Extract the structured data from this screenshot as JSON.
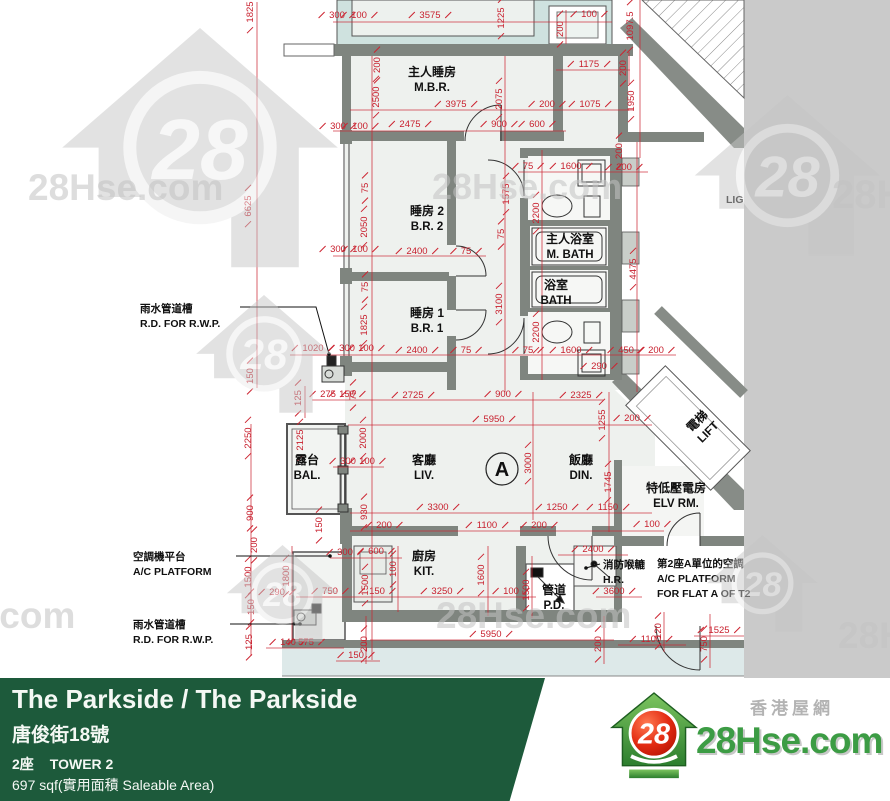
{
  "footer": {
    "title": "The Parkside / The Parkside",
    "address": "唐俊街18號",
    "tower_cn": "2座",
    "tower_en": "TOWER 2",
    "area": "697 sqf(實用面積 Saleable Area)"
  },
  "brand": {
    "site_cn": "香港屋網",
    "site_en": "28Hse.com",
    "logo_number": "28"
  },
  "watermarks": {
    "logo_number": "28",
    "houses": [
      {
        "x": 70,
        "y": 28,
        "s": 2.6
      },
      {
        "x": 700,
        "y": 95,
        "s": 1.75
      },
      {
        "x": 200,
        "y": 295,
        "s": 1.28
      },
      {
        "x": 230,
        "y": 545,
        "s": 1.05
      },
      {
        "x": 710,
        "y": 535,
        "s": 1.05
      }
    ],
    "texts": [
      {
        "t": "28Hse.com",
        "x": 28,
        "y": 200,
        "size": 37
      },
      {
        "t": "28Hse.com",
        "x": 432,
        "y": 199,
        "size": 36
      },
      {
        "t": "28Hse.com",
        "x": 832,
        "y": 208,
        "size": 40
      },
      {
        "t": "28Hse.com",
        "x": 436,
        "y": 628,
        "size": 37
      },
      {
        "t": "28Hse.com",
        "x": -120,
        "y": 628,
        "size": 37
      },
      {
        "t": "28Hse.com",
        "x": 838,
        "y": 648,
        "size": 37
      }
    ]
  },
  "plan": {
    "flat_label": "A",
    "rooms": [
      {
        "cn": "主人睡房",
        "en": "M.B.R.",
        "x": 432,
        "y": 76
      },
      {
        "cn": "睡房 2",
        "en": "B.R. 2",
        "x": 427,
        "y": 215
      },
      {
        "cn": "睡房 1",
        "en": "B.R. 1",
        "x": 427,
        "y": 317
      },
      {
        "cn": "主人浴室",
        "en": "M. BATH",
        "x": 570,
        "y": 243
      },
      {
        "cn": "浴室",
        "en": "BATH",
        "x": 556,
        "y": 289
      },
      {
        "cn": "露台",
        "en": "BAL.",
        "x": 307,
        "y": 464
      },
      {
        "cn": "客廳",
        "en": "LIV.",
        "x": 424,
        "y": 464
      },
      {
        "cn": "飯廳",
        "en": "DIN.",
        "x": 581,
        "y": 464
      },
      {
        "cn": "廚房",
        "en": "KIT.",
        "x": 424,
        "y": 560
      },
      {
        "cn": "管道",
        "en": "P.D.",
        "x": 554,
        "y": 594
      },
      {
        "cn": "電梯",
        "en": "LIFT",
        "x": 700,
        "y": 424,
        "rot": -45
      },
      {
        "cn": "特低壓電房",
        "en": "ELV RM.",
        "x": 676,
        "y": 492
      }
    ],
    "annotations": [
      {
        "lines": [
          "雨水管道槽",
          "R.D. FOR R.W.P."
        ],
        "x": 140,
        "y": 312,
        "leader": [
          [
            240,
            307
          ],
          [
            316,
            307
          ],
          [
            329,
            354
          ]
        ]
      },
      {
        "lines": [
          "空調機平台",
          "A/C PLATFORM"
        ],
        "x": 133,
        "y": 560,
        "leader": [
          [
            236,
            556
          ],
          [
            330,
            556
          ]
        ]
      },
      {
        "lines": [
          "雨水管道槽",
          "R.D. FOR R.W.P."
        ],
        "x": 133,
        "y": 628,
        "leader": [
          [
            230,
            624
          ],
          [
            300,
            624
          ]
        ]
      },
      {
        "lines": [
          "消防喉轆",
          "H.R."
        ],
        "x": 603,
        "y": 568,
        "leader": [
          [
            600,
            564
          ],
          [
            586,
            568
          ]
        ]
      },
      {
        "lines": [
          "第2座A單位的空調",
          "A/C PLATFORM",
          "FOR FLAT A OF T2"
        ],
        "x": 657,
        "y": 567
      },
      {
        "lines": [
          "LIG"
        ],
        "x": 726,
        "y": 203
      }
    ],
    "dimensions": [
      [
        "1825",
        253,
        12,
        1
      ],
      [
        "300",
        337,
        18,
        0
      ],
      [
        "100",
        359,
        18,
        0
      ],
      [
        "3575",
        430,
        18,
        0
      ],
      [
        "100",
        589,
        17,
        0
      ],
      [
        "1225",
        504,
        18,
        1
      ],
      [
        "200",
        563,
        29,
        1
      ],
      [
        "1097.5",
        633,
        26,
        1
      ],
      [
        "1175",
        589,
        67,
        0
      ],
      [
        "200",
        626,
        68,
        1
      ],
      [
        "1950",
        634,
        101,
        1
      ],
      [
        "200",
        622,
        151,
        1
      ],
      [
        "200",
        380,
        65,
        1
      ],
      [
        "2500",
        379,
        97,
        1
      ],
      [
        "3975",
        456,
        107,
        0
      ],
      [
        "2075",
        502,
        99,
        1
      ],
      [
        "200",
        547,
        107,
        0
      ],
      [
        "1075",
        590,
        107,
        0
      ],
      [
        "300",
        338,
        129,
        0
      ],
      [
        "100",
        360,
        129,
        0
      ],
      [
        "2475",
        410,
        127,
        0
      ],
      [
        "900",
        499,
        127,
        0
      ],
      [
        "600",
        537,
        127,
        0
      ],
      [
        "6625",
        251,
        206,
        1
      ],
      [
        "75",
        368,
        188,
        1
      ],
      [
        "2050",
        367,
        227,
        1
      ],
      [
        "1575",
        509,
        194,
        1
      ],
      [
        "75",
        528,
        169,
        0
      ],
      [
        "1600",
        571,
        169,
        0
      ],
      [
        "200",
        624,
        170,
        0
      ],
      [
        "2200",
        539,
        213,
        1
      ],
      [
        "75",
        504,
        234,
        1
      ],
      [
        "300",
        338,
        252,
        0
      ],
      [
        "100",
        360,
        252,
        0
      ],
      [
        "2400",
        417,
        254,
        0
      ],
      [
        "75",
        466,
        254,
        0
      ],
      [
        "3100",
        502,
        304,
        1
      ],
      [
        "4475",
        636,
        269,
        1
      ],
      [
        "75",
        368,
        287,
        1
      ],
      [
        "1825",
        367,
        325,
        1
      ],
      [
        "2200",
        539,
        332,
        1
      ],
      [
        "1020",
        313,
        351,
        0
      ],
      [
        "300",
        347,
        351,
        0
      ],
      [
        "100",
        366,
        351,
        0
      ],
      [
        "2400",
        417,
        353,
        0
      ],
      [
        "75",
        466,
        353,
        0
      ],
      [
        "75",
        528,
        353,
        0
      ],
      [
        "1600",
        571,
        353,
        0
      ],
      [
        "450",
        626,
        353,
        0
      ],
      [
        "200",
        656,
        353,
        0
      ],
      [
        "290",
        599,
        369,
        0
      ],
      [
        "150",
        253,
        376,
        1
      ],
      [
        "125",
        301,
        398,
        1
      ],
      [
        "275",
        328,
        397,
        0
      ],
      [
        "150",
        347,
        397,
        0
      ],
      [
        "75",
        356,
        395,
        1
      ],
      [
        "2725",
        413,
        398,
        0
      ],
      [
        "900",
        503,
        397,
        0
      ],
      [
        "2325",
        581,
        398,
        0
      ],
      [
        "5950",
        494,
        422,
        0
      ],
      [
        "200",
        632,
        421,
        0
      ],
      [
        "1255",
        605,
        420,
        1
      ],
      [
        "2250",
        251,
        438,
        1
      ],
      [
        "2125",
        303,
        440,
        1
      ],
      [
        "2000",
        366,
        438,
        1
      ],
      [
        "300",
        348,
        464,
        0
      ],
      [
        "100",
        367,
        464,
        0
      ],
      [
        "3000",
        531,
        463,
        1
      ],
      [
        "1745",
        611,
        482,
        1
      ],
      [
        "3300",
        438,
        510,
        0
      ],
      [
        "1250",
        557,
        510,
        0
      ],
      [
        "1150",
        608,
        510,
        0
      ],
      [
        "900",
        253,
        513,
        1
      ],
      [
        "930",
        367,
        512,
        1
      ],
      [
        "150",
        322,
        525,
        1
      ],
      [
        "200",
        384,
        528,
        0
      ],
      [
        "1100",
        487,
        528,
        0
      ],
      [
        "200",
        539,
        528,
        0
      ],
      [
        "100",
        652,
        527,
        0
      ],
      [
        "200",
        257,
        545,
        1
      ],
      [
        "1500",
        251,
        577,
        1
      ],
      [
        "1800",
        289,
        576,
        1
      ],
      [
        "290",
        277,
        595,
        0
      ],
      [
        "300",
        345,
        555,
        0
      ],
      [
        "600",
        376,
        554,
        0
      ],
      [
        "100",
        396,
        569,
        1
      ],
      [
        "1500",
        368,
        585,
        1
      ],
      [
        "2400",
        593,
        552,
        0
      ],
      [
        "750",
        330,
        594,
        0
      ],
      [
        "150",
        377,
        594,
        0
      ],
      [
        "3250",
        442,
        594,
        0
      ],
      [
        "100",
        511,
        594,
        0
      ],
      [
        "1600",
        484,
        575,
        1
      ],
      [
        "1500",
        529,
        590,
        1
      ],
      [
        "3600",
        614,
        594,
        0
      ],
      [
        "150",
        254,
        607,
        1
      ],
      [
        "125",
        252,
        642,
        1
      ],
      [
        "140",
        288,
        645,
        0
      ],
      [
        "575",
        306,
        645,
        0
      ],
      [
        "200",
        367,
        644,
        1
      ],
      [
        "150",
        356,
        658,
        0
      ],
      [
        "5950",
        491,
        637,
        0
      ],
      [
        "200",
        601,
        644,
        1
      ],
      [
        "1100",
        651,
        642,
        0
      ],
      [
        "120",
        661,
        631,
        1
      ],
      [
        "750",
        707,
        644,
        1
      ],
      [
        "1525",
        719,
        633,
        0
      ]
    ]
  },
  "colors": {
    "dimension_red": "#c8202e",
    "wall_gray": "#7f857f",
    "adjacent_teal": "#cfe2df",
    "floor_fill": "#eef1ee",
    "banner_green": "#1d5a3b",
    "brand_green": "#3c9c44",
    "side_band_gray": "#cacaca"
  }
}
